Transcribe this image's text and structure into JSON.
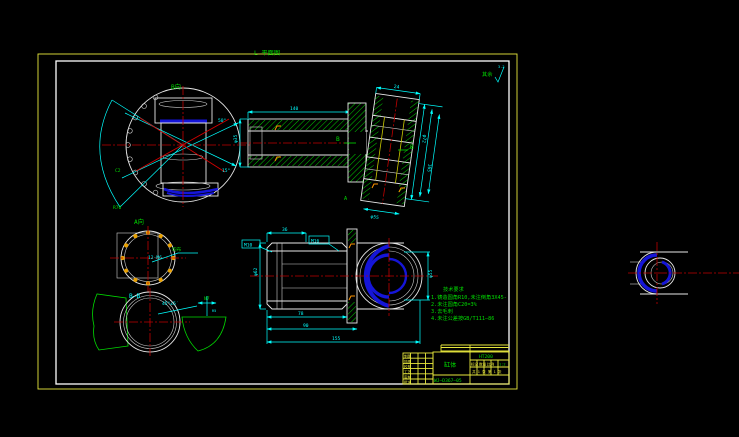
{
  "colors": {
    "background": "#000000",
    "paper_border": "#e8e83c",
    "frame": "#ffffff",
    "dimension": "#00ffff",
    "centerline": "#d40000",
    "hatch": "#00cc00",
    "highlight_blue": "#1515d8",
    "annotation_green": "#00dc00",
    "title_block_yellow": "#e8e83c",
    "bolt_hole_orange": "#e8a000"
  },
  "frame": {
    "plan_label": "L 平面图",
    "surface_default": "其余",
    "roughness_value": "3.2"
  },
  "views": {
    "front": {
      "name": "B向",
      "angle_dim": "50°",
      "angle_dim2": "15°",
      "chamfer": "C2",
      "fan_radius": "R70"
    },
    "section_top": {
      "label_b1": "B",
      "label_b2": "B",
      "label_a": "A",
      "dim_top": "24",
      "dim_left": "φ35",
      "dim_length": "140",
      "dim_r1": "φ72",
      "dim_r2": "165",
      "dim_bottom": "φ55"
    },
    "bolt_circle": {
      "name": "A向",
      "callout": "12-M6",
      "callout_note": "均布"
    },
    "section_bb": {
      "name": "B—B",
      "angle": "45°±5′"
    },
    "side": {
      "callout_box": "M10",
      "thread": "M16",
      "dim_top": "36",
      "dim_left": "φ62",
      "dim_b1": "78",
      "dim_b2": "90",
      "dim_b3": "155",
      "dim_right": "φ55"
    },
    "detail": {
      "name": "N7",
      "dim": "R5"
    }
  },
  "notes": {
    "title": "技术要求",
    "items": [
      "1.铸造圆角R10,未注倒角3X45-",
      "2.未注圆角C20=3%",
      "3.去毛刺",
      "4.未注公差按GB/T111—86"
    ]
  },
  "title_block": {
    "part_name": "缸体",
    "drawing_no": "WJ—D367—05",
    "material": "HT200",
    "field_mark": "标记",
    "field_qty": "数量",
    "field_scale": "比例",
    "scale": "1:2",
    "sheet": "共 1 张 第 1 张",
    "signatures": [
      "制图",
      "描图",
      "校核",
      "工艺",
      "审核",
      "批准"
    ]
  }
}
